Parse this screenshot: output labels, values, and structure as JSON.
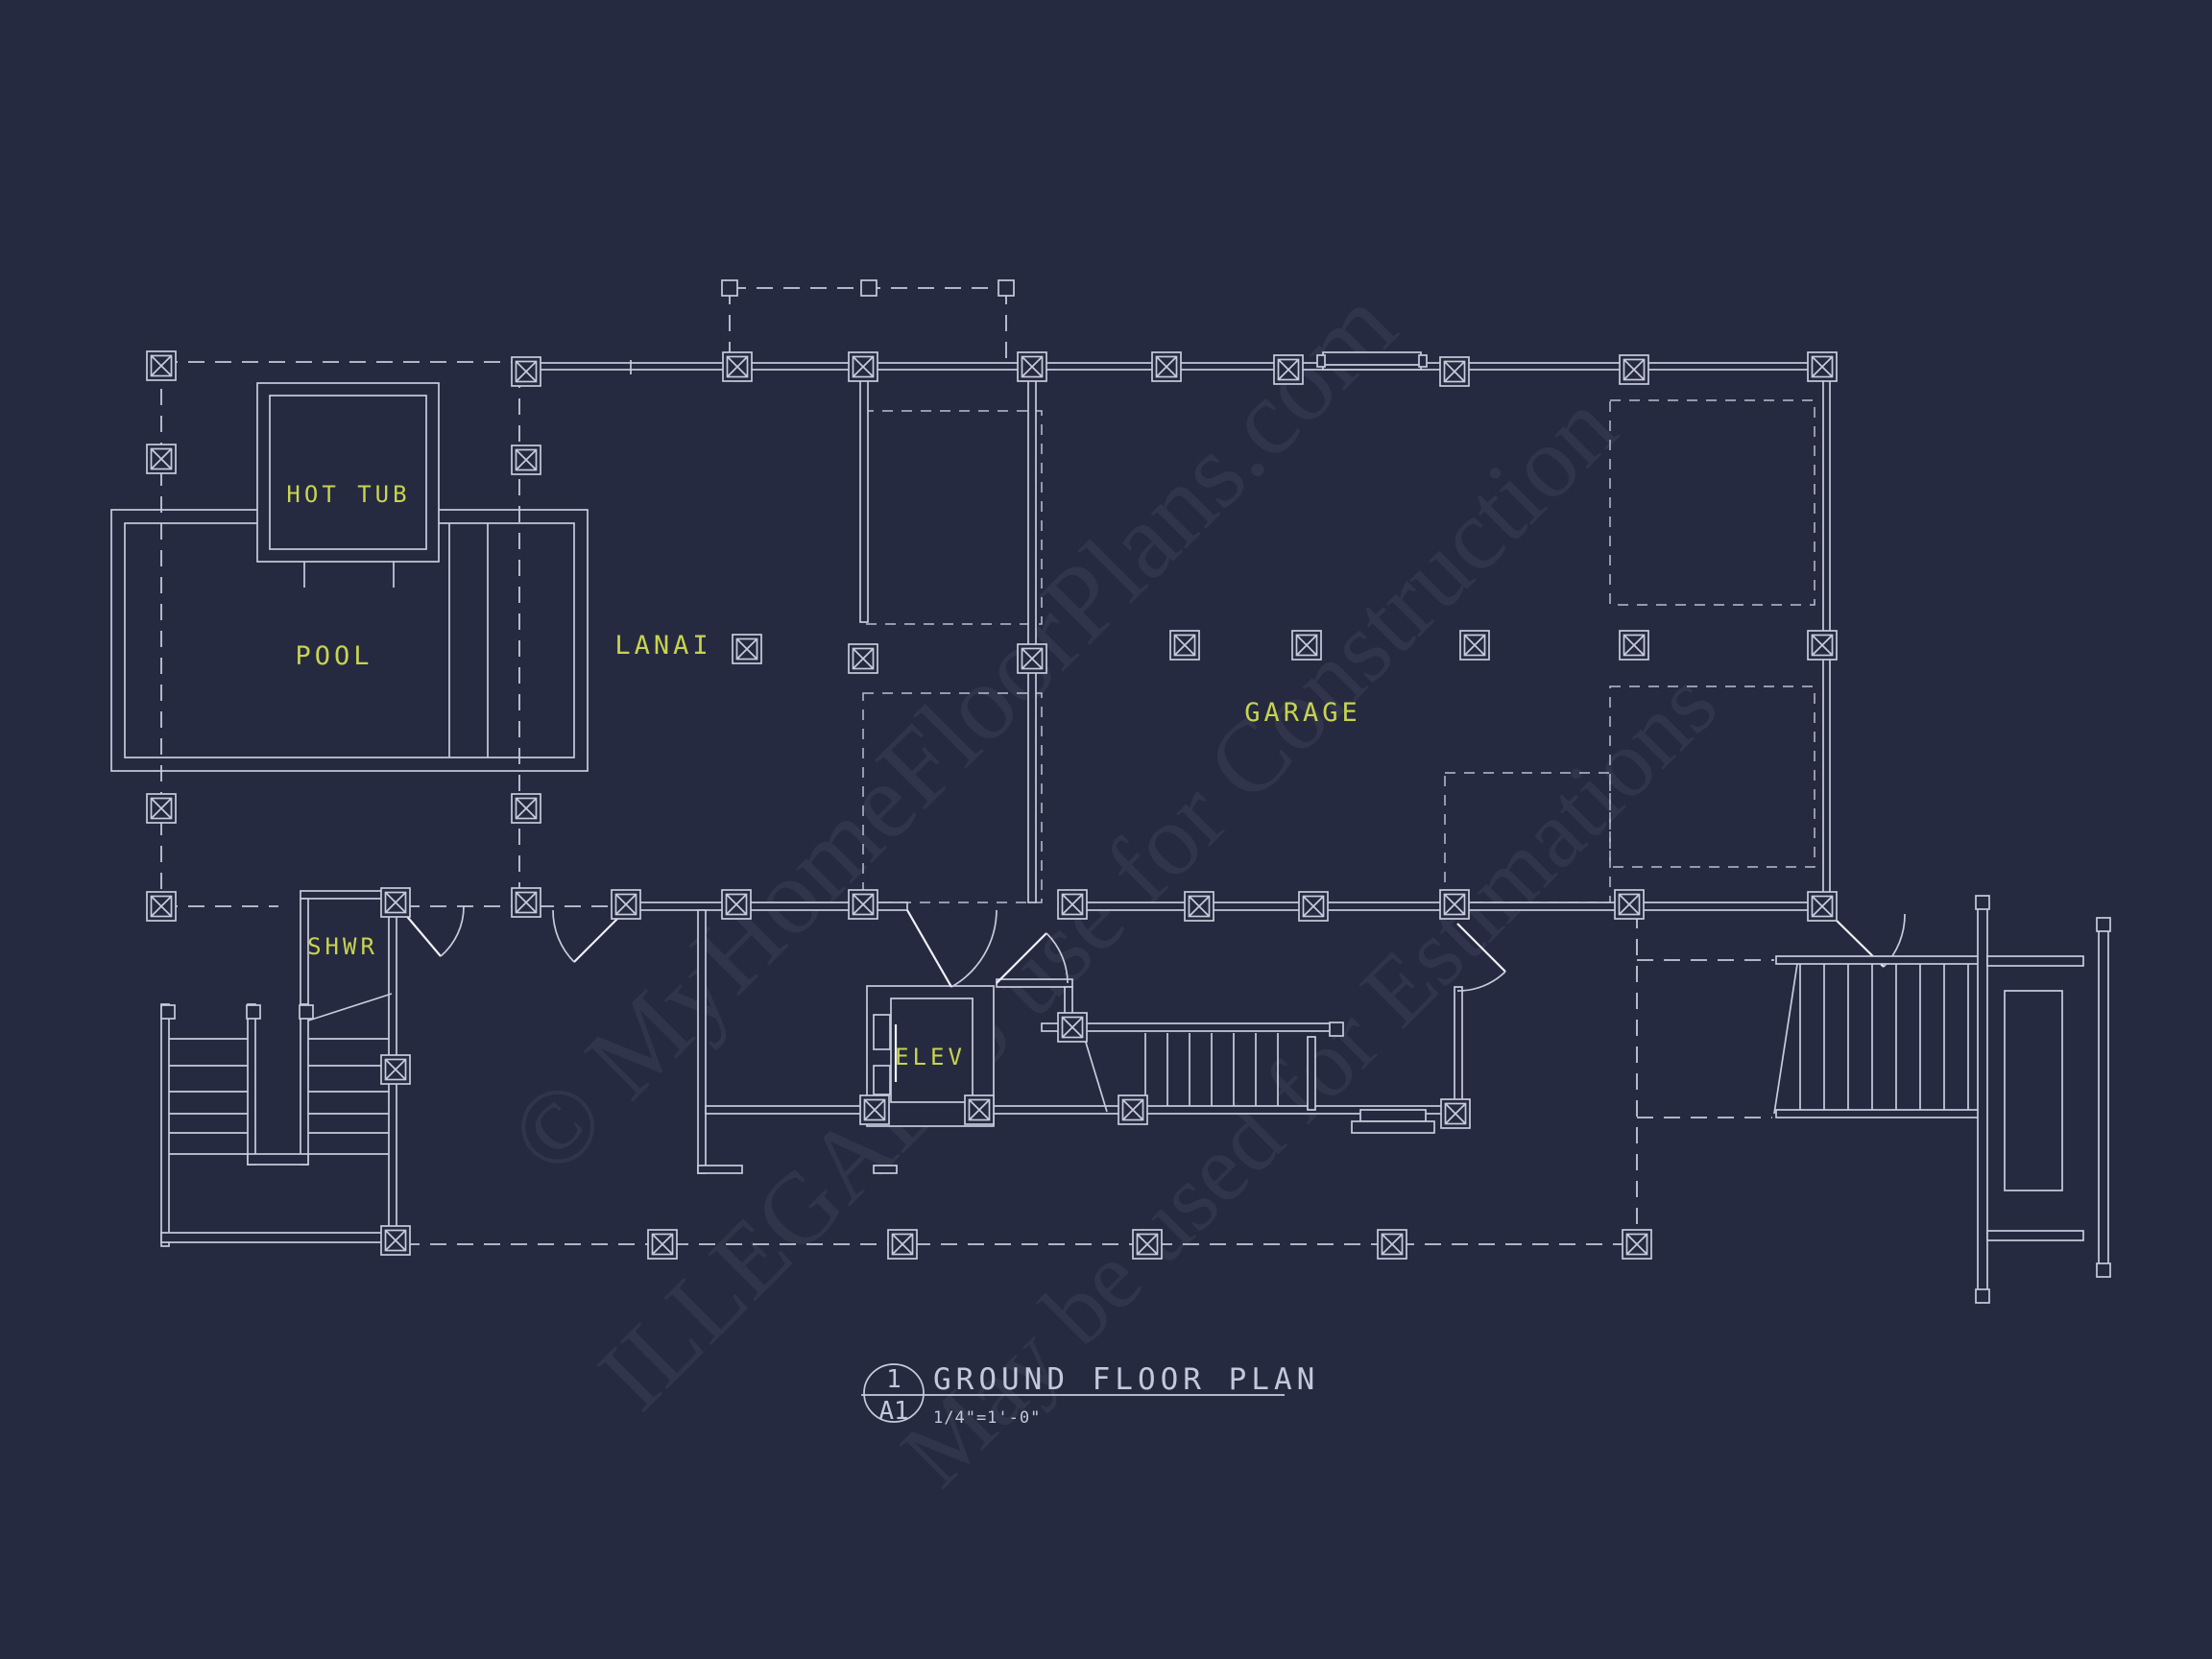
{
  "drawing": {
    "type": "architectural-floor-plan",
    "background_color": "#262a40",
    "line_color": "#c7ccdc",
    "label_color": "#c8d44f",
    "title_color": "#c3c9da",
    "room_labels": [
      {
        "id": "hot-tub",
        "text": "HOT TUB"
      },
      {
        "id": "pool",
        "text": "POOL"
      },
      {
        "id": "lanai",
        "text": "LANAI"
      },
      {
        "id": "garage",
        "text": "GARAGE"
      },
      {
        "id": "shwr",
        "text": "SHWR"
      },
      {
        "id": "elev",
        "text": "ELEV"
      }
    ],
    "title_block": {
      "detail_number": "1",
      "sheet_number": "A1",
      "title": "GROUND FLOOR PLAN",
      "scale": "1/4\"=1'-0\""
    },
    "watermark": {
      "line1": "© MyHomeFloorPlans.com",
      "line2": "ILLEGAL to use for Construction",
      "line3": "May be used for Estimations"
    }
  }
}
